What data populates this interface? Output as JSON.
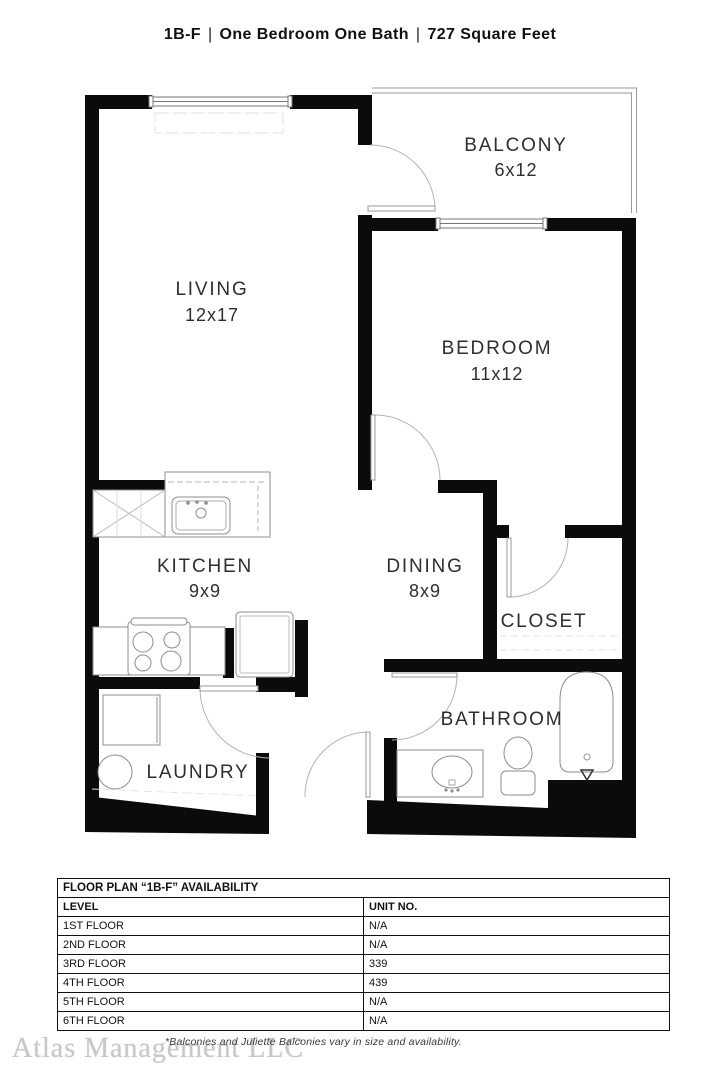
{
  "title": {
    "code": "1B-F",
    "separator": "|",
    "type": "One Bedroom One Bath",
    "size": "727 Square Feet"
  },
  "floorplan": {
    "rooms": [
      {
        "name": "LIVING",
        "dims": "12x17"
      },
      {
        "name": "BALCONY",
        "dims": "6x12"
      },
      {
        "name": "BEDROOM",
        "dims": "11x12"
      },
      {
        "name": "KITCHEN",
        "dims": "9x9"
      },
      {
        "name": "DINING",
        "dims": "8x9"
      },
      {
        "name": "CLOSET",
        "dims": ""
      },
      {
        "name": "LAUNDRY",
        "dims": ""
      },
      {
        "name": "BATHROOM",
        "dims": ""
      }
    ]
  },
  "availability_table": {
    "title": "FLOOR PLAN “1B-F” AVAILABILITY",
    "columns": [
      "LEVEL",
      "UNIT NO."
    ],
    "rows": [
      [
        "1ST FLOOR",
        "N/A"
      ],
      [
        "2ND FLOOR",
        "N/A"
      ],
      [
        "3RD FLOOR",
        "339"
      ],
      [
        "4TH FLOOR",
        "439"
      ],
      [
        "5TH FLOOR",
        "N/A"
      ],
      [
        "6TH FLOOR",
        "N/A"
      ]
    ]
  },
  "footer": {
    "watermark": "Atlas Management LLC",
    "disclaimer": "*Balconies and Juliette Balconies vary in size and availability."
  }
}
